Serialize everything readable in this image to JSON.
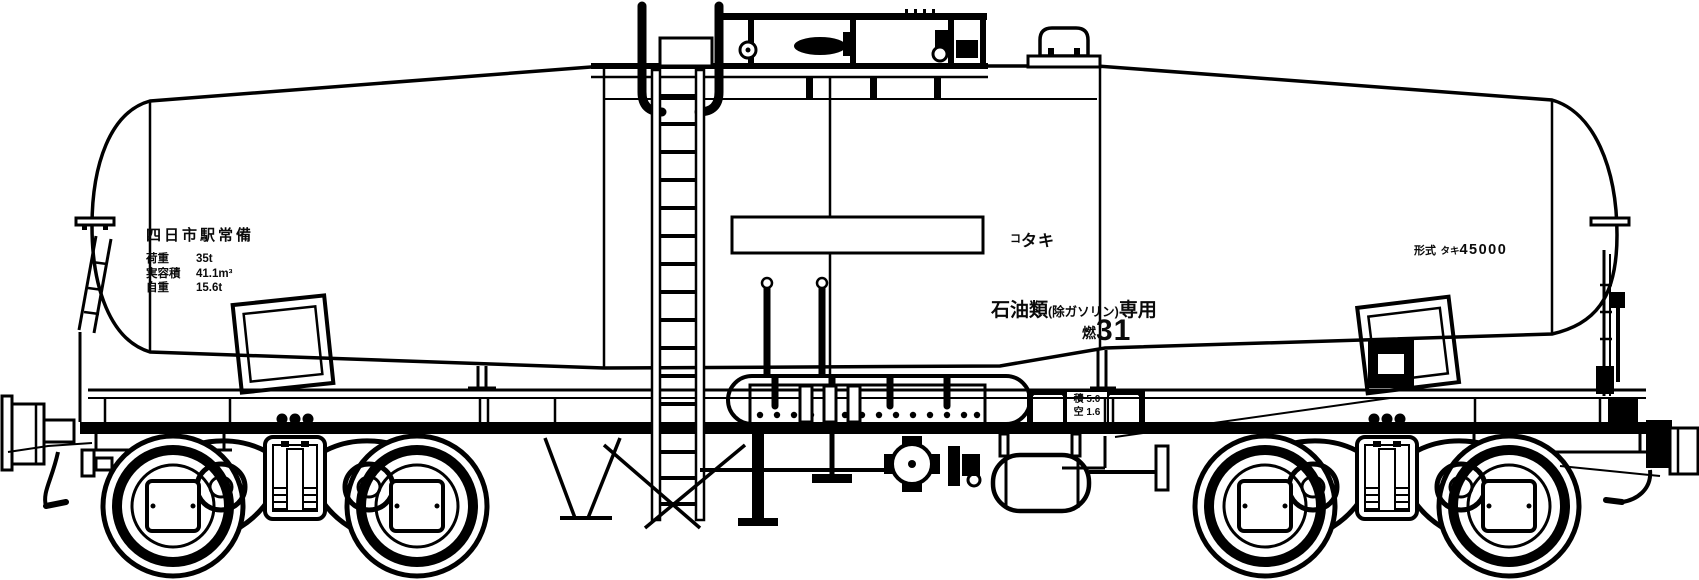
{
  "drawing": {
    "title": "tank-wagon-side-elevation",
    "background_color": "#ffffff",
    "line_color": "#000000",
    "labels": {
      "station": "四日市駅常備",
      "specs": [
        {
          "key": "荷重",
          "value": "35t"
        },
        {
          "key": "実容積",
          "value": "41.1m³"
        },
        {
          "key": "自重",
          "value": "15.6t"
        }
      ],
      "reporting_mark_prefix": "コ",
      "reporting_mark": "タキ",
      "use_main": "石油類",
      "use_paren": "(除ガソリン)",
      "use_suffix": "専用",
      "fuel_class_prefix": "燃",
      "fuel_class_number": "31",
      "type_label": "形式",
      "type_kana": "タキ",
      "type_number": "45000",
      "placard_loaded": "積 5.0",
      "placard_empty": "空 1.6"
    }
  }
}
